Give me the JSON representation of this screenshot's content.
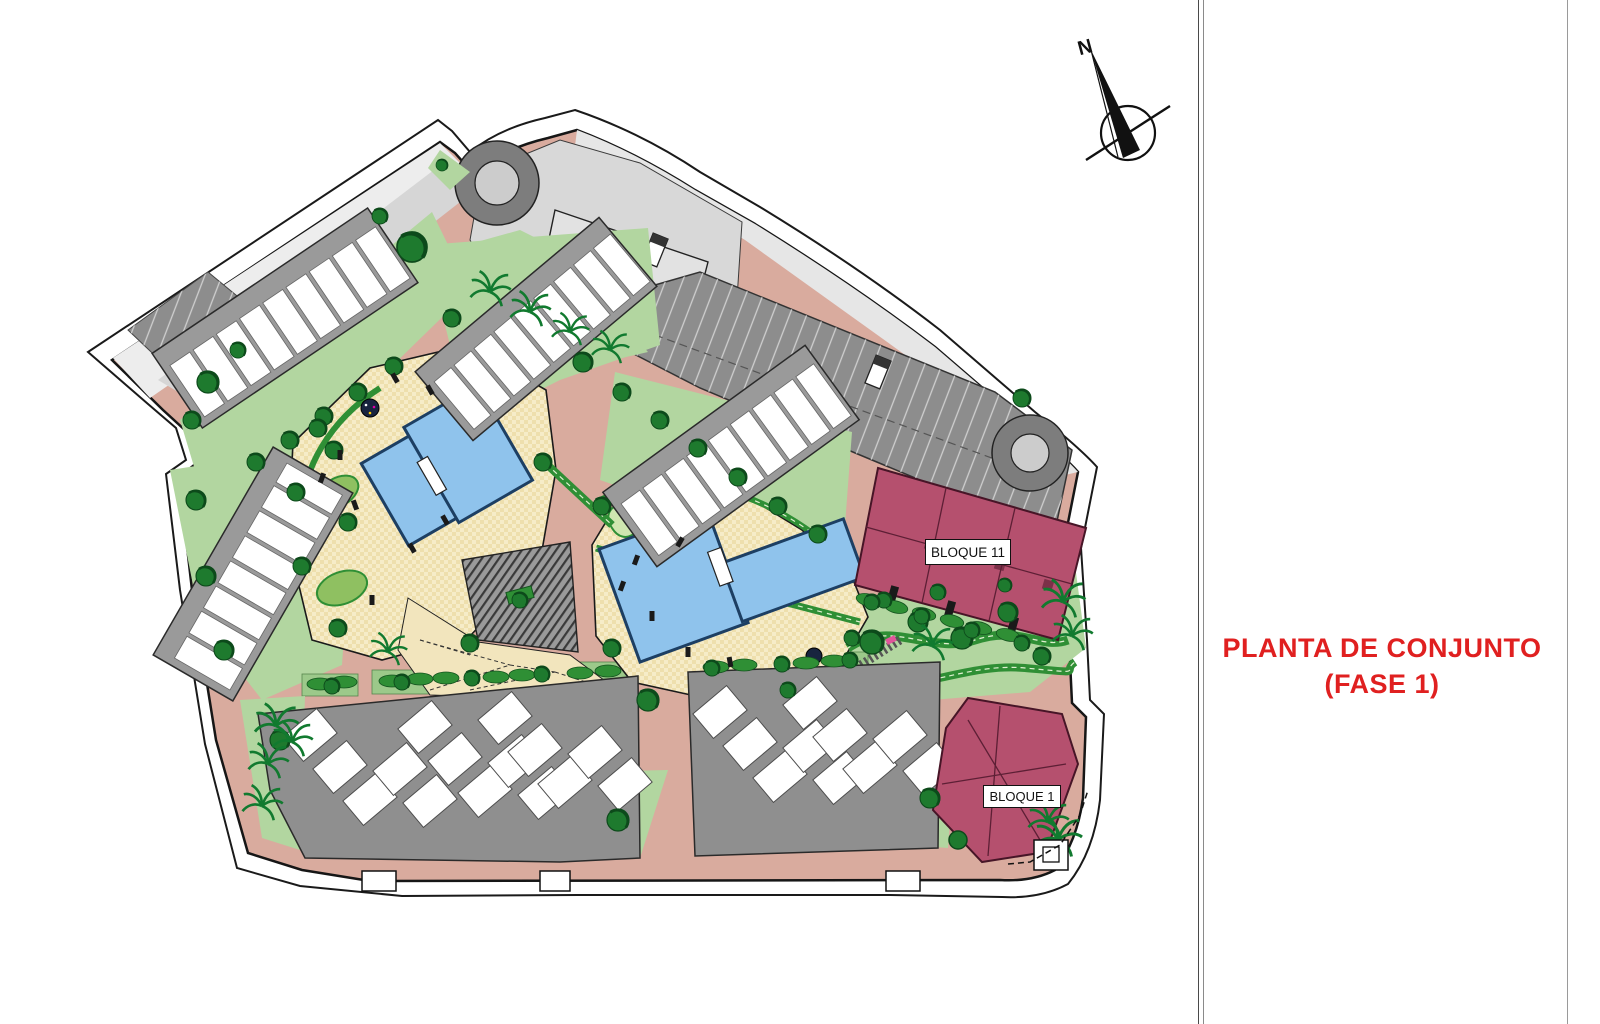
{
  "title_block": {
    "line1": "PLANTA DE CONJUNTO",
    "line2": "(FASE 1)",
    "color": "#e02020"
  },
  "compass": {
    "label": "N"
  },
  "blocks": {
    "bloque11": "BLOQUE 11",
    "bloque1": "BLOQUE 1"
  },
  "palette": {
    "road_pink": "#d9ab9e",
    "green_area": "#b2d6a0",
    "hedge_green": "#2f8f35",
    "tree_green": "#1e7a2e",
    "deck_beige": "#f6ecc8",
    "pool_blue": "#8fc3ec",
    "parking_gray": "#8d8d8d",
    "road_light_gray": "#dcdcdc",
    "building_band_gray": "#9a9a9a",
    "building_unit_white": "#ffffff",
    "highlight_block_maroon": "#b5506e",
    "boundary_black": "#161616",
    "title_red": "#e02020"
  }
}
